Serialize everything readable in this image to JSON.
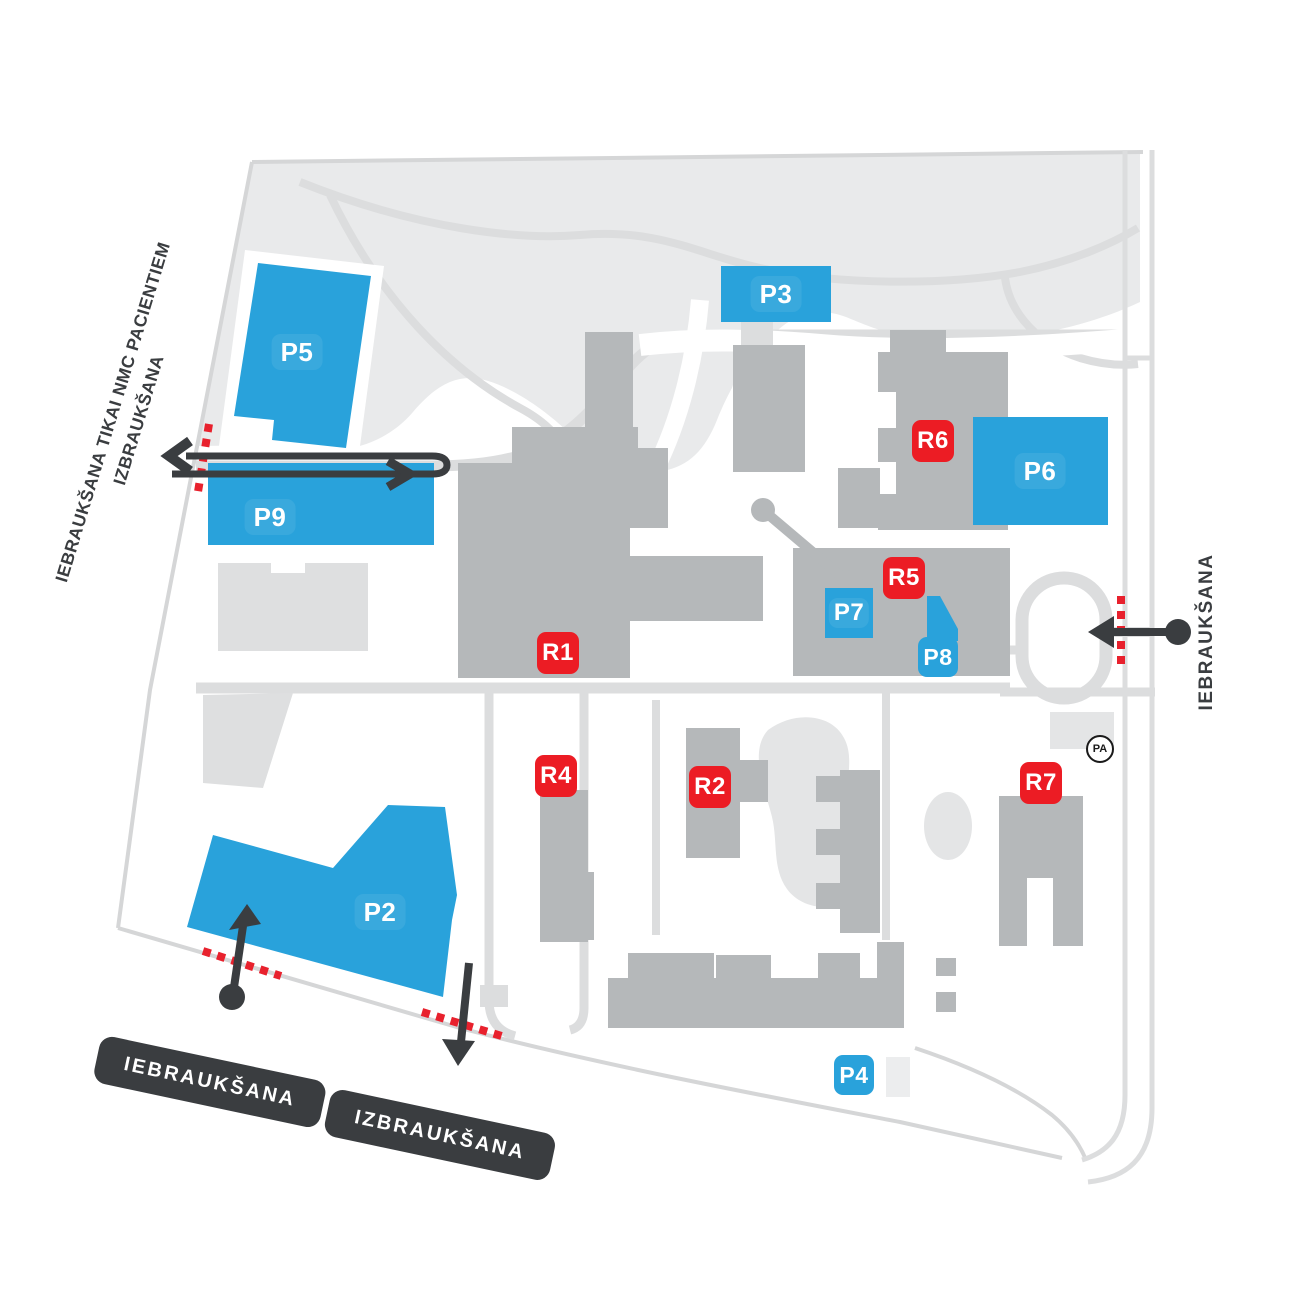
{
  "zones": {
    "p2": {
      "label": "P2"
    },
    "p3": {
      "label": "P3"
    },
    "p4": {
      "label": "P4"
    },
    "p5": {
      "label": "P5"
    },
    "p6": {
      "label": "P6"
    },
    "p7": {
      "label": "P7"
    },
    "p8": {
      "label": "P8"
    },
    "p9": {
      "label": "P9"
    }
  },
  "registration": {
    "r1": {
      "label": "R1"
    },
    "r2": {
      "label": "R2"
    },
    "r4": {
      "label": "R4"
    },
    "r5": {
      "label": "R5"
    },
    "r6": {
      "label": "R6"
    },
    "r7": {
      "label": "R7"
    }
  },
  "markers": {
    "parking_house": "PA"
  },
  "signs": {
    "entry_badge": "IEBRAUKŠANA",
    "exit_badge": "IZBRAUKŠANA",
    "left_note_line1": "IEBRAUKŠANA TIKAI NMC PACIENTIEM",
    "left_note_line2": "IZBRAUKŠANA",
    "right_note": "IEBRAUKŠANA"
  },
  "colors": {
    "zone_blue": "#29A2DB",
    "label_red": "#EC1C24",
    "ink_dark": "#3A3D40",
    "building": "#B5B8BA",
    "building_light": "#DEDFE0",
    "park": "#E9EAEB",
    "road": "#DCDDDE",
    "pond": "#E4E5E6",
    "restriction_red": "#E8212D"
  }
}
